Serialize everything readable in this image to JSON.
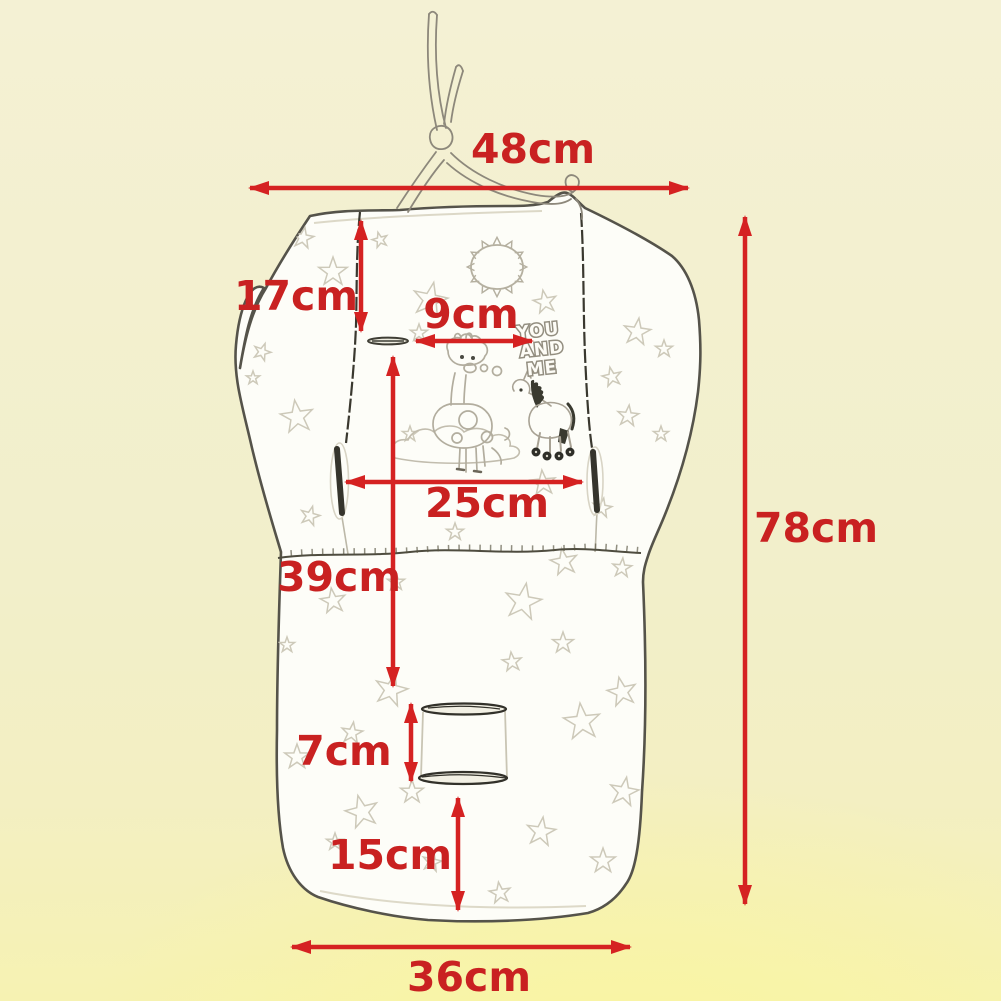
{
  "diagram": {
    "description": "Baby stroller seat pad / cushion dimension diagram",
    "measurements": {
      "top_width": {
        "label": "48cm",
        "value_cm": 48
      },
      "back_top": {
        "label": "17cm",
        "value_cm": 17
      },
      "slot_width": {
        "label": "9cm",
        "value_cm": 9
      },
      "panel_width": {
        "label": "25cm",
        "value_cm": 25
      },
      "back_height": {
        "label": "39cm",
        "value_cm": 39
      },
      "total_height": {
        "label": "78cm",
        "value_cm": 78
      },
      "buckle_gap": {
        "label": "7cm",
        "value_cm": 7
      },
      "seat_height": {
        "label": "15cm",
        "value_cm": 15
      },
      "bottom_width": {
        "label": "36cm",
        "value_cm": 36
      }
    },
    "artwork": {
      "slogan_line1": "YOU",
      "slogan_line2": "AND",
      "slogan_line3": "ME"
    },
    "colors": {
      "dimension_red": "#d52222",
      "label_red": "#c92121",
      "background_top": "#f4f1d4",
      "background_bottom": "#f6f2b2",
      "pad_fill": "#fdfdf8",
      "pad_outline": "#55534a",
      "star_outline": "#cdc9b9"
    }
  }
}
